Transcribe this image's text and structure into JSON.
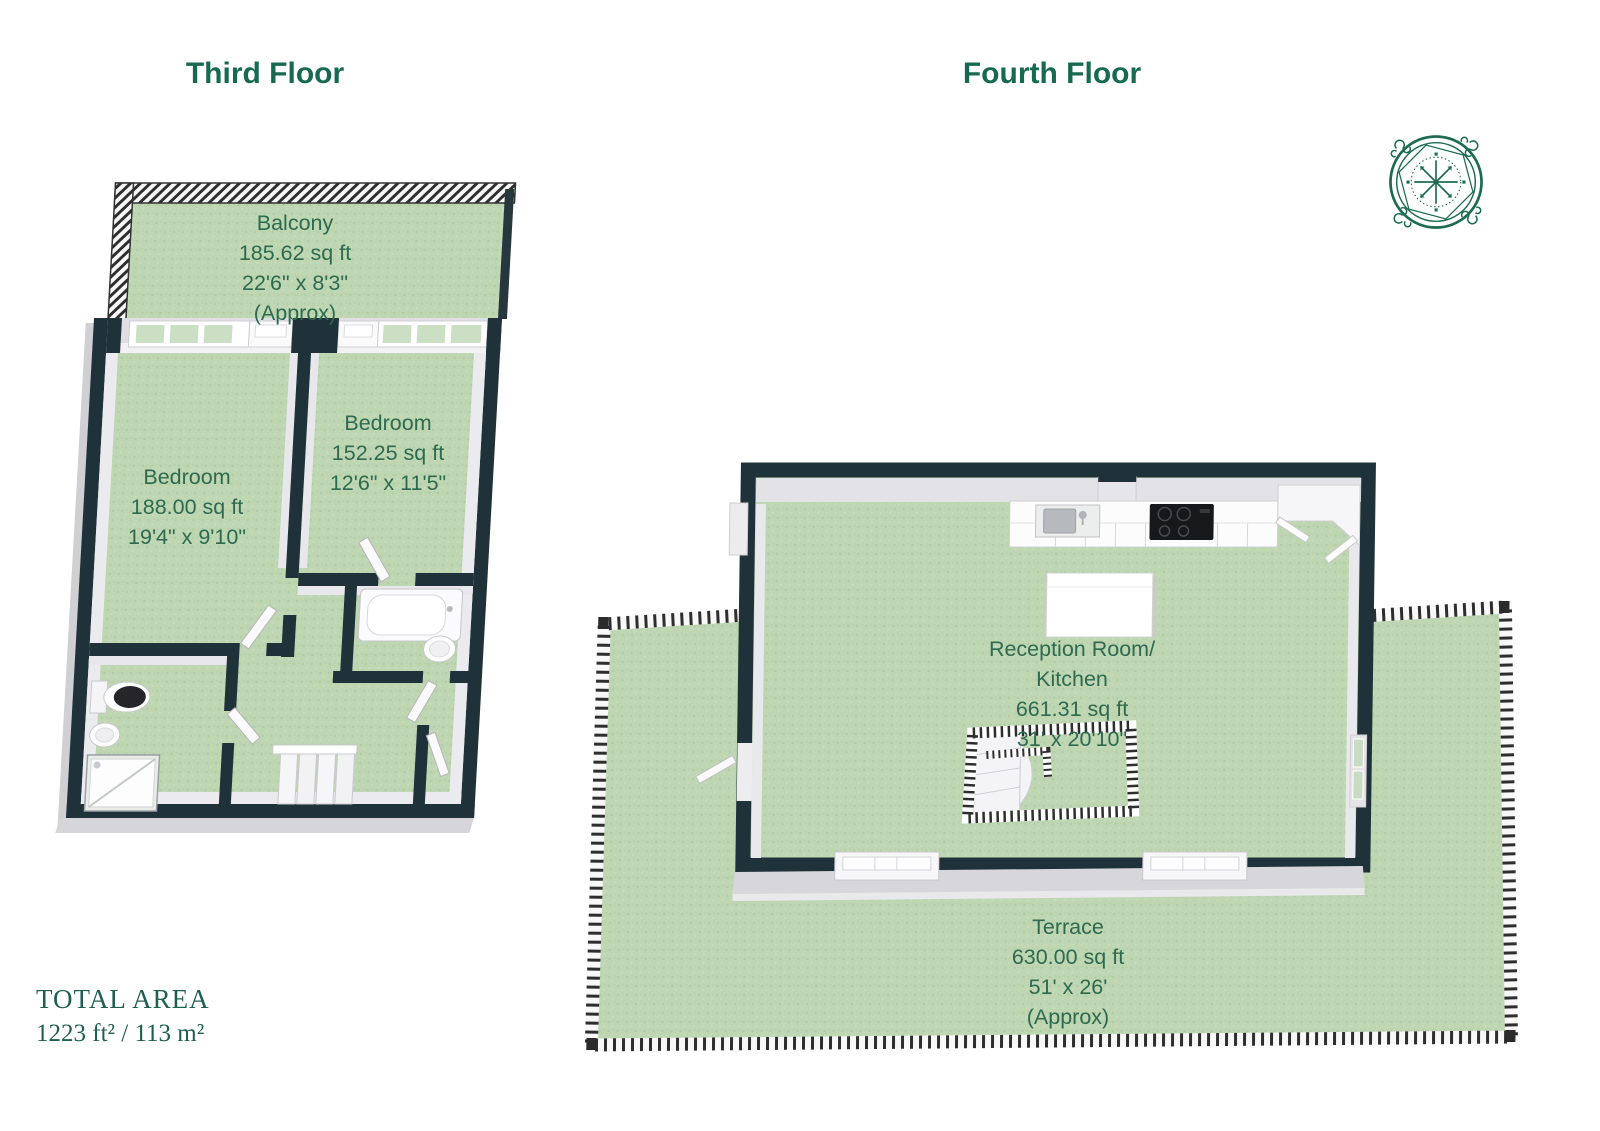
{
  "page": {
    "background": "#ffffff"
  },
  "colors": {
    "title_green": "#176a51",
    "label_green": "#2d6a50",
    "total_green": "#1e5f4f",
    "floor_green": "#bed6b2",
    "wall_dark": "#203239",
    "wall_light": "#e9e9ed",
    "railing_stripe": "#2e2e2e",
    "compass_green": "#1c6b52"
  },
  "third_floor": {
    "title": "Third Floor",
    "balcony": {
      "name": "Balcony",
      "area": "185.62 sq ft",
      "dims": "22'6\" x 8'3\"",
      "approx": "(Approx)"
    },
    "bedroom_left": {
      "name": "Bedroom",
      "area": "188.00 sq ft",
      "dims": "19'4\" x 9'10\""
    },
    "bedroom_right": {
      "name": "Bedroom",
      "area": "152.25 sq ft",
      "dims": "12'6\" x 11'5\""
    }
  },
  "fourth_floor": {
    "title": "Fourth Floor",
    "reception": {
      "name_line1": "Reception Room/",
      "name_line2": "Kitchen",
      "area": "661.31 sq ft",
      "dims": "31' x 20'10\""
    },
    "terrace": {
      "name": "Terrace",
      "area": "630.00 sq ft",
      "dims": "51' x 26'",
      "approx": "(Approx)"
    }
  },
  "total_area": {
    "label": "TOTAL AREA",
    "value": "1223 ft² / 113 m²"
  },
  "icons": {
    "compass": "compass-rose"
  }
}
